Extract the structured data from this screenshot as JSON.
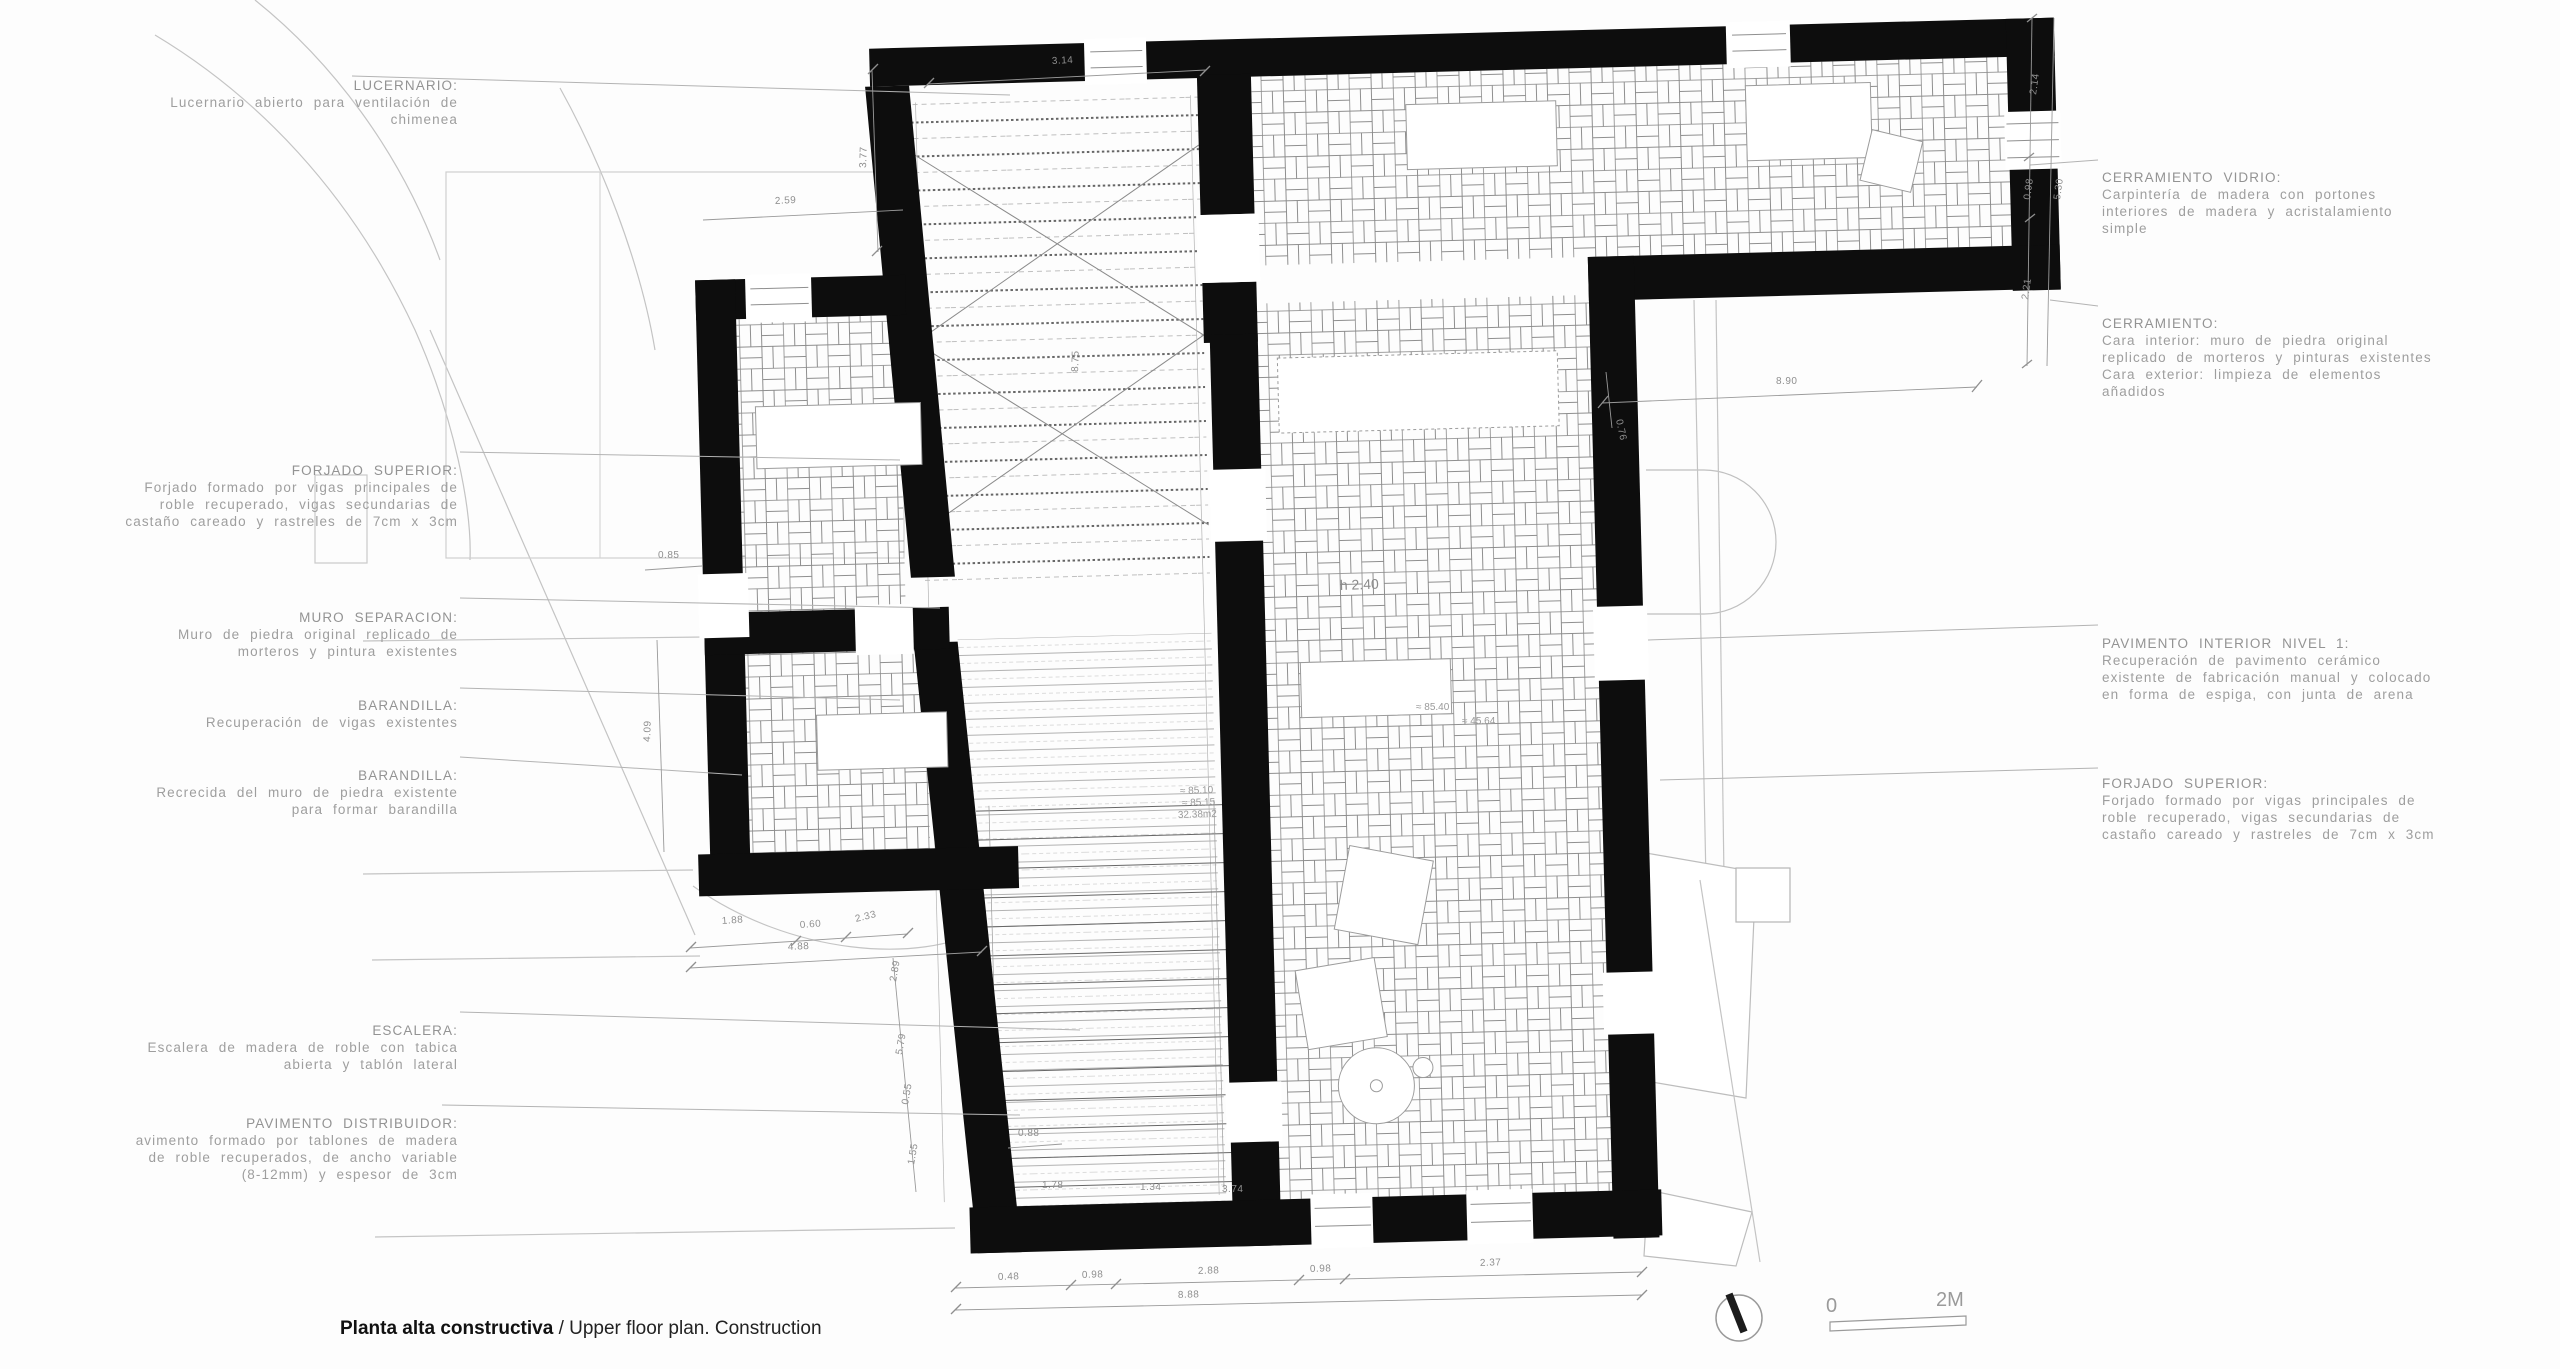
{
  "caption": {
    "bold": "Planta alta constructiva",
    "regular": " / Upper floor plan. Construction"
  },
  "scale_bar": {
    "zero": "0",
    "two_m": "2M"
  },
  "left_annotations": [
    {
      "title": "LUCERNARIO:",
      "body": "Lucernario abierto para ventilación de\nchimenea"
    },
    {
      "title": "FORJADO SUPERIOR:",
      "body": "Forjado formado por vigas principales de\nroble recuperado, vigas secundarias de\ncastaño careado y rastreles de 7cm x 3cm"
    },
    {
      "title": "MURO SEPARACION:",
      "body": "Muro de piedra original replicado de\nmorteros y pintura existentes"
    },
    {
      "title": "BARANDILLA:",
      "body": "Recuperación de vigas existentes"
    },
    {
      "title": "BARANDILLA:",
      "body": "Recrecida del muro de piedra existente\npara formar barandilla"
    },
    {
      "title": "ESCALERA:",
      "body": "Escalera de madera de roble con tabica\nabierta y tablón lateral"
    },
    {
      "title": "PAVIMENTO DISTRIBUIDOR:",
      "body": "avimento formado por tablones de madera\nde roble recuperados, de ancho variable\n(8-12mm) y espesor de 3cm"
    }
  ],
  "right_annotations": [
    {
      "title": "CERRAMIENTO VIDRIO:",
      "body": "Carpintería de madera con portones\ninteriores de madera y acristalamiento\nsimple"
    },
    {
      "title": "CERRAMIENTO:",
      "body": "Cara interior: muro de piedra original\nreplicado de morteros y pinturas existentes\nCara exterior: limpieza de elementos\nañadidos"
    },
    {
      "title": "PAVIMENTO INTERIOR NIVEL 1:",
      "body": "Recuperación de pavimento cerámico\nexistente de fabricación manual y colocado\nen forma de espiga, con junta de arena"
    },
    {
      "title": "FORJADO SUPERIOR:",
      "body": "Forjado formado por vigas principales de\nroble recuperado, vigas secundarias de\ncastaño careado y rastreles de 7cm x 3cm"
    }
  ],
  "dims": {
    "top_width": "3.14",
    "left_v1": "3.77",
    "left_h1": "2.59",
    "left_h2": "0.85",
    "left_v2": "4.09",
    "stair_a": "1.88",
    "stair_b": "0.60",
    "stair_c": "2.33",
    "stair_total": "4.88",
    "sv1": "2.89",
    "sv2": "5.79",
    "sv3": "0.55",
    "sv4": "1.55",
    "s088": "0.88",
    "b1": "1.78",
    "b2": "1.34",
    "b3": "3.74",
    "shaft_v": "8.75",
    "right_h": "8.90",
    "right_h_small": "0.76",
    "rv1": "2.14",
    "rv2": "0.98",
    "rv3": "2.21",
    "rv_total": "5.30",
    "bc1": "0.48",
    "bc2": "0.98",
    "bc3": "2.88",
    "bc4": "0.98",
    "bc5": "2.37",
    "bc_total": "8.88",
    "room_h": "h 2.40",
    "lvl1a": "≈ 85.40",
    "lvl1b": "≈ 45.64",
    "lvl2a": "≈ 85.10",
    "lvl2b": "≈ 85.15",
    "lvl2c": "32.38m2"
  },
  "colors": {
    "wall": "#0d0d0d",
    "tile_line": "#8a8a8a",
    "dim": "#8f8f8f",
    "annotation": "#9e9e9e",
    "context": "#c4c4c4"
  }
}
